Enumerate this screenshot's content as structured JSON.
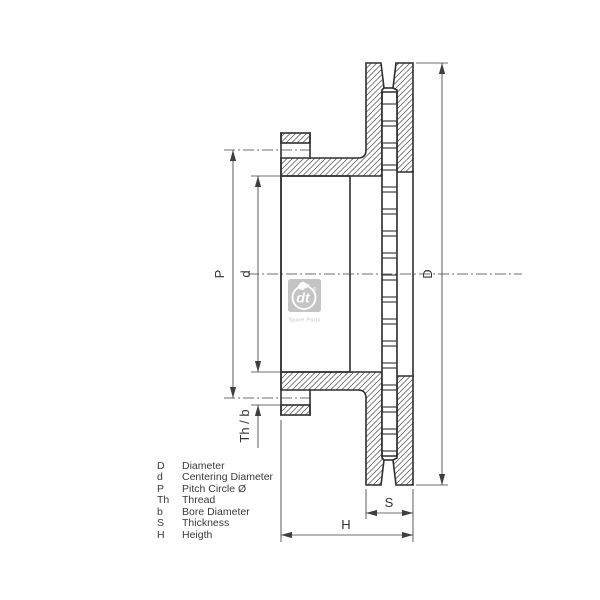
{
  "drawing": {
    "type": "brake-disc cross-section",
    "dimension_labels": {
      "P": "P",
      "d": "d",
      "D": "D",
      "S": "S",
      "H": "H",
      "Th_b": "Th / b"
    },
    "legend": {
      "items": [
        {
          "term": "D",
          "desc": "Diameter"
        },
        {
          "term": "d",
          "desc": "Centering Diameter"
        },
        {
          "term": "P",
          "desc": "Pitch Circle Ø"
        },
        {
          "term": "Th",
          "desc": "Thread"
        },
        {
          "term": "b",
          "desc": "Bore Diameter"
        },
        {
          "term": "S",
          "desc": "Thickness"
        },
        {
          "term": "H",
          "desc": "Heigth"
        }
      ]
    },
    "watermark": {
      "brand": "dt",
      "registered": "®",
      "caption": "Spare Parts"
    },
    "colors": {
      "line": "#2f2f2f",
      "thin_line": "#3f3f3f",
      "text": "#3a3a3a",
      "watermark": "#c4c4c4",
      "background": "#ffffff"
    }
  }
}
